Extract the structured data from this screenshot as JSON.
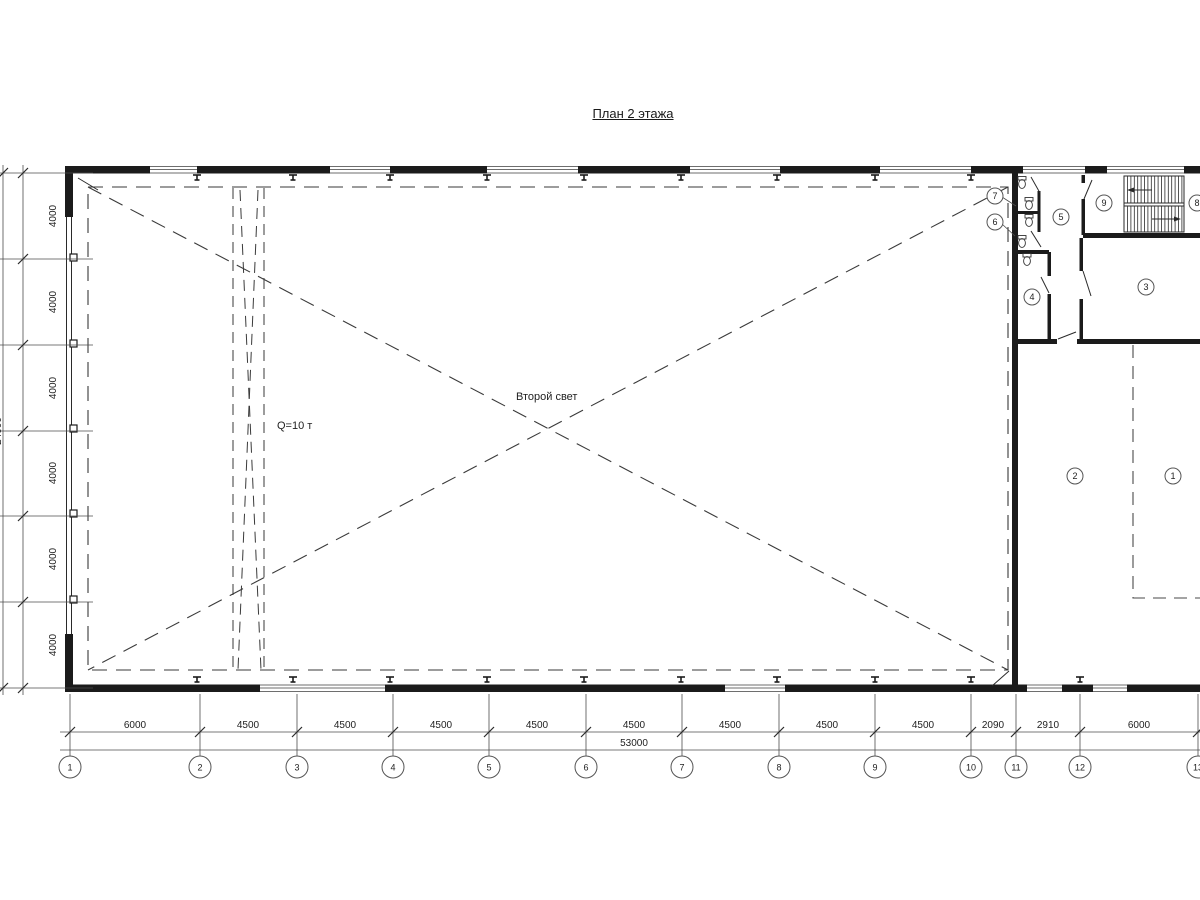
{
  "sheet": {
    "title": "План 2 этажа"
  },
  "plan_labels": {
    "second_light": "Второй свет",
    "crane_capacity": "Q=10 т"
  },
  "axes_bottom": [
    {
      "label": "1",
      "x": 70
    },
    {
      "label": "2",
      "x": 200
    },
    {
      "label": "3",
      "x": 297
    },
    {
      "label": "4",
      "x": 393
    },
    {
      "label": "5",
      "x": 489
    },
    {
      "label": "6",
      "x": 586
    },
    {
      "label": "7",
      "x": 682
    },
    {
      "label": "8",
      "x": 779
    },
    {
      "label": "9",
      "x": 875
    },
    {
      "label": "10",
      "x": 971
    },
    {
      "label": "11",
      "x": 1016
    },
    {
      "label": "12",
      "x": 1080
    },
    {
      "label": "13",
      "x": 1198
    }
  ],
  "dims_bottom": [
    {
      "value": "6000",
      "x": 135
    },
    {
      "value": "4500",
      "x": 248
    },
    {
      "value": "4500",
      "x": 345
    },
    {
      "value": "4500",
      "x": 441
    },
    {
      "value": "4500",
      "x": 537
    },
    {
      "value": "4500",
      "x": 634
    },
    {
      "value": "4500",
      "x": 730
    },
    {
      "value": "4500",
      "x": 827
    },
    {
      "value": "4500",
      "x": 923
    },
    {
      "value": "2090",
      "x": 993
    },
    {
      "value": "2910",
      "x": 1048
    },
    {
      "value": "6000",
      "x": 1139
    }
  ],
  "total_bottom": {
    "value": "53000",
    "x": 634
  },
  "dims_left": [
    {
      "value": "4000",
      "y": 216
    },
    {
      "value": "4000",
      "y": 302
    },
    {
      "value": "4000",
      "y": 388
    },
    {
      "value": "4000",
      "y": 473
    },
    {
      "value": "4000",
      "y": 559
    },
    {
      "value": "4000",
      "y": 645
    }
  ],
  "total_left": {
    "value": "24000",
    "y": 431
  },
  "rooms": [
    {
      "label": "1",
      "x": 1173,
      "y": 476
    },
    {
      "label": "2",
      "x": 1075,
      "y": 476
    },
    {
      "label": "3",
      "x": 1146,
      "y": 287
    },
    {
      "label": "4",
      "x": 1032,
      "y": 297
    },
    {
      "label": "5",
      "x": 1061,
      "y": 217
    },
    {
      "label": "6",
      "x": 995,
      "y": 222
    },
    {
      "label": "7",
      "x": 995,
      "y": 196
    },
    {
      "label": "8",
      "x": 1197,
      "y": 203
    },
    {
      "label": "9",
      "x": 1104,
      "y": 203
    }
  ],
  "colors": {
    "wall": "#1b1b1b",
    "dashed": "#3a3a3a",
    "dimension": "#4c4c4c"
  }
}
